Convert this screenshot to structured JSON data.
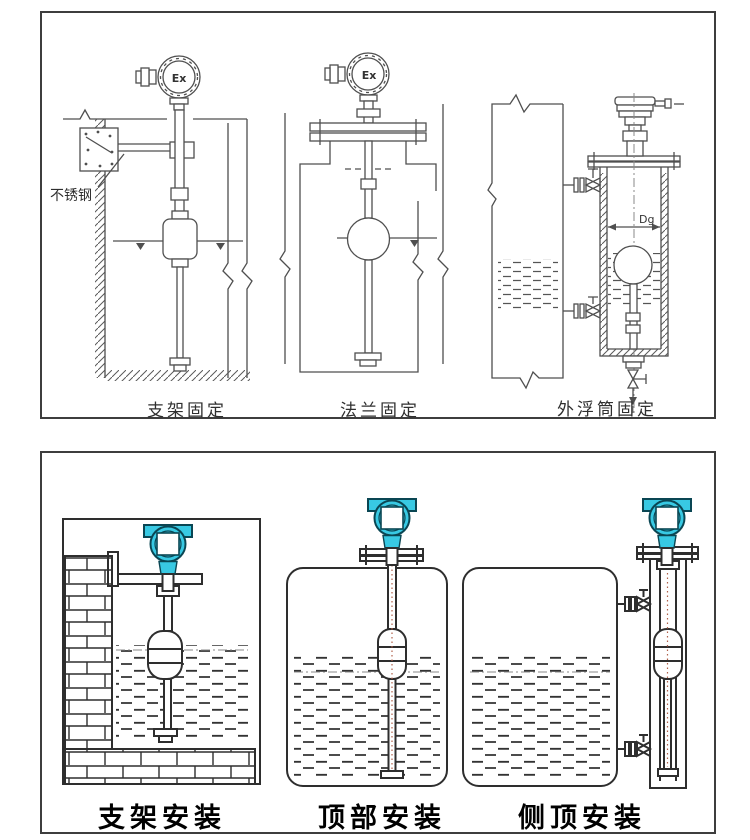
{
  "colors": {
    "line_top": "#4f4f4f",
    "line_bottom": "#2e2e2e",
    "transmitter_teal": "#38c9e3",
    "transmitter_outline": "#0a4653",
    "rod_centerline": "#b0604a",
    "caption_top": "#2f2f2f",
    "caption_bottom": "#000000"
  },
  "top_panel": {
    "figures": [
      {
        "id": "bracket-fixing",
        "caption": "支架固定",
        "annotation": "不锈钢",
        "head_label": "Ex"
      },
      {
        "id": "flange-fixing",
        "caption": "法兰固定",
        "head_label": "Ex"
      },
      {
        "id": "external-chamber-fixing",
        "caption": "外浮筒固定",
        "dimension_label": "Dg"
      }
    ]
  },
  "bottom_panel": {
    "figures": [
      {
        "id": "bracket-install",
        "caption": "支架安装"
      },
      {
        "id": "top-install",
        "caption": "顶部安装"
      },
      {
        "id": "side-top-install",
        "caption": "侧顶安装"
      }
    ]
  }
}
